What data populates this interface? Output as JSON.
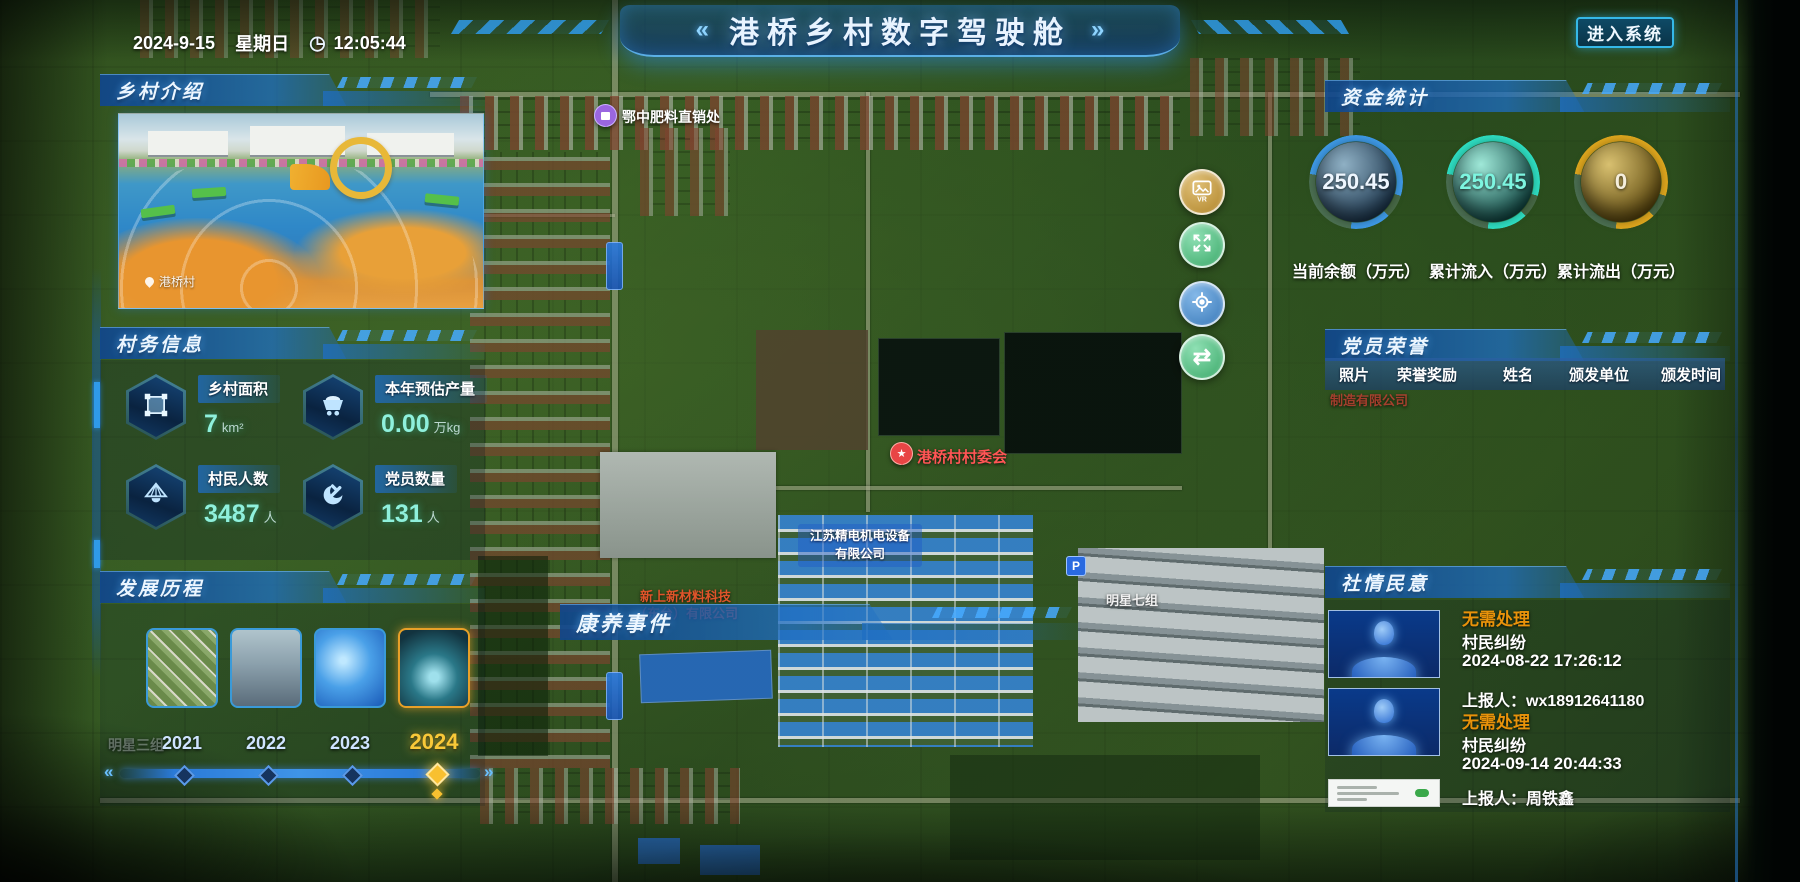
{
  "datetime": {
    "date": "2024-9-15",
    "weekday": "星期日",
    "time": "12:05:44"
  },
  "icons": {
    "clock": "◷",
    "chevrons_left": "«",
    "chevrons_right": "»",
    "swap": "⇄",
    "slider_prev": "«",
    "slider_next": "»",
    "parking": "P"
  },
  "header": {
    "title": "港桥乡村数字驾驶舱",
    "enter_button": "进入系统"
  },
  "panels": {
    "village_intro": {
      "title": "乡村介绍",
      "photo_caption": "港桥村"
    },
    "village_info": {
      "title": "村务信息",
      "stats": [
        {
          "icon": "land-area-icon",
          "label": "乡村面积",
          "value": "7",
          "unit": "km²"
        },
        {
          "icon": "harvest-cart-icon",
          "label": "本年预估产量",
          "value": "0.00",
          "unit": "万kg"
        },
        {
          "icon": "villager-hat-icon",
          "label": "村民人数",
          "value": "3487",
          "unit": "人"
        },
        {
          "icon": "party-emblem-icon",
          "label": "党员数量",
          "value": "131",
          "unit": "人"
        }
      ]
    },
    "development": {
      "title": "发展历程",
      "items": [
        {
          "year": "2021",
          "active": false
        },
        {
          "year": "2022",
          "active": false
        },
        {
          "year": "2023",
          "active": false
        },
        {
          "year": "2024",
          "active": true
        }
      ]
    },
    "funds": {
      "title": "资金统计",
      "gauges": [
        {
          "value": "250.45",
          "label": "当前余额（万元）",
          "ring_color": "#3f9be8",
          "value_color": "#eef6ff"
        },
        {
          "value": "250.45",
          "label": "累计流入（万元）",
          "ring_color": "#2fe0c4",
          "value_color": "#7df5e0"
        },
        {
          "value": "0",
          "label": "累计流出（万元）",
          "ring_color": "#e0a81e",
          "value_color": "#f5eedc"
        }
      ]
    },
    "honors": {
      "title": "党员荣誉",
      "columns": [
        "照片",
        "荣誉奖励",
        "姓名",
        "颁发单位",
        "颁发时间"
      ]
    },
    "sentiment": {
      "title": "社情民意",
      "status_color": "#e8920a",
      "items": [
        {
          "status": "无需处理",
          "category": "村民纠纷",
          "time": "2024-08-22 17:26:12",
          "reporter": "上报人：wx18912641180"
        },
        {
          "status": "无需处理",
          "category": "村民纠纷",
          "time": "2024-09-14 20:44:33",
          "reporter": "上报人：周铁鑫"
        }
      ]
    }
  },
  "map": {
    "events_panel_title": "康养事件",
    "markers": [
      {
        "label": "鄂中肥料直销处",
        "type": "purple-pin"
      },
      {
        "label": "港桥村村委会",
        "type": "red-star-pin",
        "glyph": "★"
      }
    ],
    "labels": {
      "company1_line1": "新上新材料科技",
      "company1_line2": "（东台）有限公司",
      "company2_line1": "江苏精电机电设备",
      "company2_line2": "有限公司",
      "company3": "制造有限公司",
      "group7": "明星七组",
      "group3": "明星三组"
    }
  }
}
